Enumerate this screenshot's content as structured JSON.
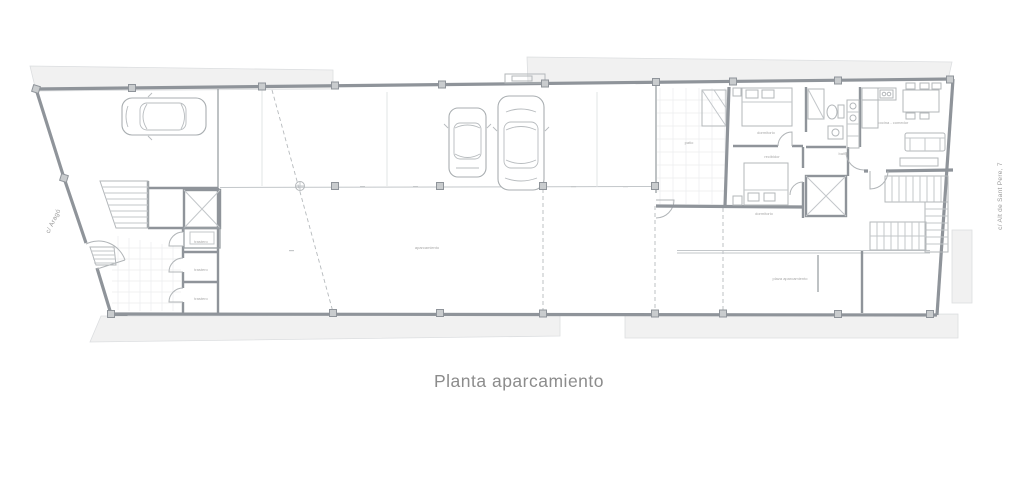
{
  "title": "Planta aparcamiento",
  "streets": {
    "left": "c/ Aragó",
    "right": "c/ Alt de Sant Pere, 7"
  },
  "room_labels": {
    "parking": "aparcamiento",
    "parking_space": "plaza aparcamiento",
    "storage_1": "trastero",
    "storage_2": "trastero",
    "storage_3": "trastero",
    "bedroom_1": "dormitorio",
    "bedroom_2": "dormitorio",
    "bathroom": "baño",
    "kitchen_living": "cocina - comedor",
    "hall": "recibidor",
    "patio": "patio"
  },
  "colors": {
    "wall": "#8f949a",
    "thin_line": "#c3c7ca",
    "sidewalk": "#f1f1f1",
    "label": "#a8a8a8",
    "title": "#8c8c8c",
    "background": "#ffffff"
  }
}
